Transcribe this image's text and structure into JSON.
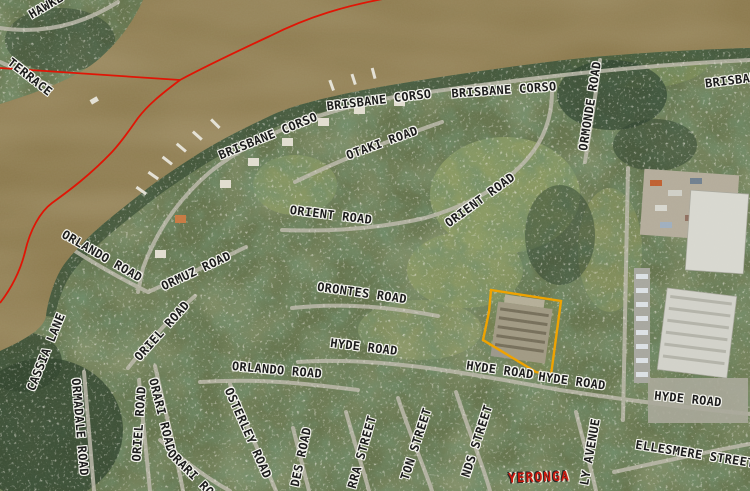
{
  "map": {
    "colors": {
      "water": "#8e7c50",
      "land": "#66754e",
      "boundary": "#e01505",
      "parcel_highlight": "#f0a300",
      "road": "#bdbaac",
      "suburb_text": "#cc1a0e"
    },
    "suburb_labels": [
      {
        "text": "YERONGA",
        "x": 539,
        "y": 478,
        "rot": -2,
        "color": "#cc1a0e"
      }
    ],
    "street_labels": [
      {
        "text": "HAWKE",
        "x": 46,
        "y": 6,
        "rot": -30
      },
      {
        "text": "TERRACE",
        "x": 30,
        "y": 77,
        "rot": 38
      },
      {
        "text": "BRISBANE CORSO",
        "x": 268,
        "y": 136,
        "rot": -22
      },
      {
        "text": "BRISBANE CORSO",
        "x": 379,
        "y": 100,
        "rot": -7
      },
      {
        "text": "BRISBANE CORSO",
        "x": 504,
        "y": 90,
        "rot": -4
      },
      {
        "text": "BRISBANE",
        "x": 735,
        "y": 80,
        "rot": -7
      },
      {
        "text": "OTAKI ROAD",
        "x": 382,
        "y": 143,
        "rot": -20
      },
      {
        "text": "ORMONDE ROAD",
        "x": 590,
        "y": 106,
        "rot": -81
      },
      {
        "text": "ORIENT ROAD",
        "x": 331,
        "y": 215,
        "rot": 7
      },
      {
        "text": "ORIENT ROAD",
        "x": 480,
        "y": 200,
        "rot": -36
      },
      {
        "text": "ORLANDO ROAD",
        "x": 102,
        "y": 256,
        "rot": 30
      },
      {
        "text": "ORMUZ ROAD",
        "x": 196,
        "y": 271,
        "rot": -25
      },
      {
        "text": "ORIEL ROAD",
        "x": 162,
        "y": 331,
        "rot": -48
      },
      {
        "text": "CASSIA LANE",
        "x": 46,
        "y": 352,
        "rot": -68
      },
      {
        "text": "ORMADALE ROAD",
        "x": 80,
        "y": 427,
        "rot": 85
      },
      {
        "text": "ORIEL ROAD",
        "x": 139,
        "y": 424,
        "rot": -86
      },
      {
        "text": "ORARI ROAD",
        "x": 162,
        "y": 415,
        "rot": 76
      },
      {
        "text": "ORARI ROAD",
        "x": 196,
        "y": 478,
        "rot": 45
      },
      {
        "text": "OSTERLEY ROAD",
        "x": 248,
        "y": 433,
        "rot": 66
      },
      {
        "text": "ORLANDO ROAD",
        "x": 277,
        "y": 370,
        "rot": 5
      },
      {
        "text": "ORONTES ROAD",
        "x": 362,
        "y": 293,
        "rot": 8
      },
      {
        "text": "HYDE ROAD",
        "x": 364,
        "y": 347,
        "rot": 7
      },
      {
        "text": "HYDE ROAD",
        "x": 500,
        "y": 370,
        "rot": 8
      },
      {
        "text": "HYDE ROAD",
        "x": 572,
        "y": 381,
        "rot": 8
      },
      {
        "text": "HYDE ROAD",
        "x": 688,
        "y": 399,
        "rot": 6
      },
      {
        "text": "ELLESMERE STREET",
        "x": 695,
        "y": 454,
        "rot": 9
      },
      {
        "text": "DES ROAD",
        "x": 301,
        "y": 457,
        "rot": -78
      },
      {
        "text": "RRA STREET",
        "x": 362,
        "y": 452,
        "rot": -74
      },
      {
        "text": "TON STREET",
        "x": 416,
        "y": 444,
        "rot": -72
      },
      {
        "text": "NDS STREET",
        "x": 477,
        "y": 441,
        "rot": -72
      },
      {
        "text": "LY AVENUE",
        "x": 590,
        "y": 452,
        "rot": -80
      }
    ]
  }
}
